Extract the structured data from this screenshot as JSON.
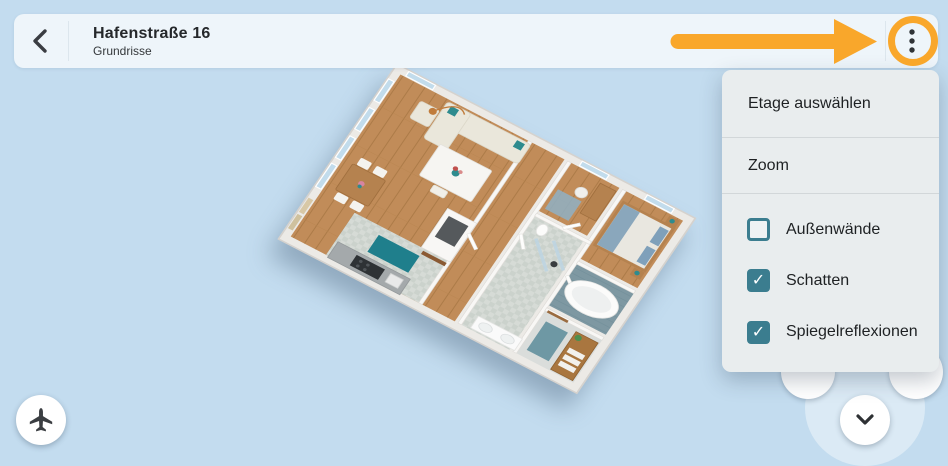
{
  "header": {
    "title": "Hafenstraße 16",
    "subtitle": "Grundrisse"
  },
  "menu": {
    "items": [
      {
        "label": "Etage auswählen"
      },
      {
        "label": "Zoom"
      }
    ],
    "checkboxes": [
      {
        "label": "Außenwände",
        "checked": false
      },
      {
        "label": "Schatten",
        "checked": true
      },
      {
        "label": "Spiegelreflexionen",
        "checked": true
      }
    ]
  },
  "icons": {
    "back": "chevron-left",
    "more": "kebab-vertical-dots",
    "collapse": "chevron-down",
    "airplane": "airplane"
  },
  "colors": {
    "background_blue": "#c3dcef",
    "header_bg": "#eef5fa",
    "menu_bg": "#e9edee",
    "accent_teal": "#3b7d8f",
    "annotation_orange": "#f9a72b",
    "icon_dark": "#33373b",
    "wood_floor": "#c18c59",
    "tile_floor": "#d4d9d4",
    "bath_floor": "#7e98a2",
    "teal_rug": "#1f7f8c"
  }
}
